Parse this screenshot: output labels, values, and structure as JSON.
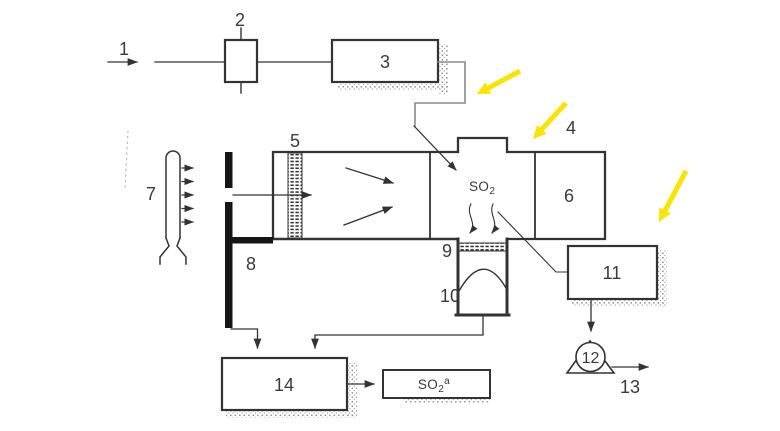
{
  "palette": {
    "ink": "#333333",
    "pipe_gray": "#8a8a8a",
    "highlight_yellow": "#f7e400",
    "stipple_gray": "#8f8f8f",
    "barrier_black": "#151515"
  },
  "labels": {
    "item1": "1",
    "item2": "2",
    "item3": "3",
    "item4": "4",
    "item5": "5",
    "item6": "6",
    "item7": "7",
    "item8": "8",
    "item9": "9",
    "item10": "10",
    "item11": "11",
    "item12": "12",
    "item13": "13",
    "item14": "14",
    "so2_chamber": {
      "base": "SO",
      "sub": "2"
    },
    "so2_sample": {
      "base": "SO",
      "sub": "2",
      "sup": "a"
    }
  }
}
